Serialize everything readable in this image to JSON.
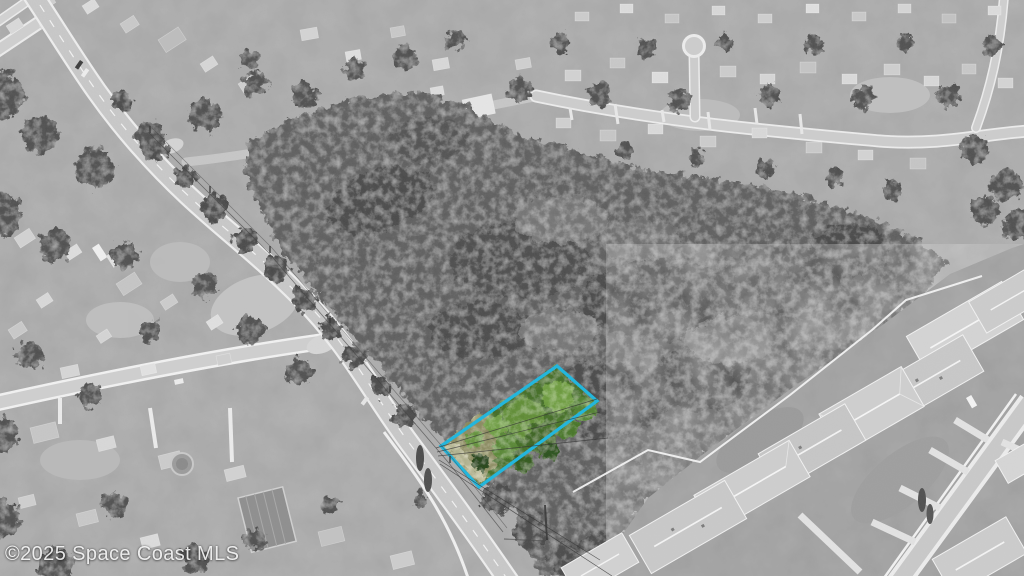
{
  "scene": {
    "kind": "aerial-photograph",
    "treatment": "black-and-white aerial photo with one color-highlighted vacant lot",
    "setting": "suburban neighborhood, wooded scrub land, main road, new home development"
  },
  "watermark": {
    "text": "©2025 Space Coast MLS"
  },
  "parcel": {
    "outline_color": "#1cb6de"
  }
}
